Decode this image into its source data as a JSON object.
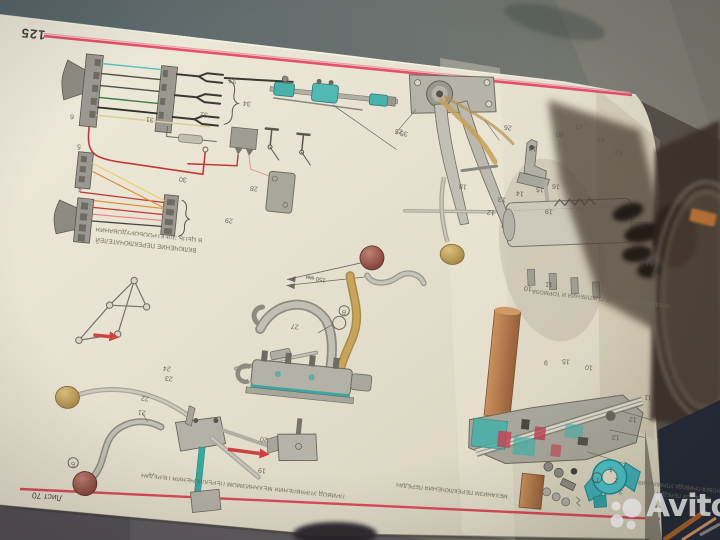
{
  "page": {
    "number": "125",
    "sheet": "Лист 70"
  },
  "watermark": {
    "text": "Avito"
  },
  "figures": {
    "wiring": {
      "caption_line1": "ВКЛЮЧЕНИЕ ПЕРЕКЛЮЧАТЕЛЕЙ",
      "caption_line2": "В ЦЕПЬ ЭЛЕКТРООБОРУДОВАНИЯ"
    },
    "pedals_cylinder": {
      "caption": "УСТАНОВКА ПЕДАЛЕЙ СЦЕПЛЕНИЯ И ТОРМОЗА"
    },
    "shift_linkage": {
      "caption": "ПРИВОД УПРАВЛЕНИЯ МЕХАНИЗМОМ ПЕРЕКЛЮЧЕНИЯ ПЕРЕДАЧ"
    },
    "shift_tower": {
      "caption": "МЕХАНИЗМ ПЕРЕКЛЮЧЕНИЯ ПЕРЕДАЧ"
    },
    "gearbox": {
      "caption_line1": "УСТАНОВКА ПРИВОДА УПРАВЛЕНИЯ",
      "caption_line2": "КОРОБКОЙ ПЕРЕДАЧ"
    },
    "dimension_label": "150 мм"
  },
  "part_labels": [
    {
      "t": "6",
      "x": 72,
      "y": 116
    },
    {
      "t": "31",
      "x": 150,
      "y": 119
    },
    {
      "t": "32",
      "x": 204,
      "y": 114
    },
    {
      "t": "33",
      "x": 233,
      "y": 80
    },
    {
      "t": "34",
      "x": 247,
      "y": 103
    },
    {
      "t": "28",
      "x": 254,
      "y": 188
    },
    {
      "t": "30",
      "x": 183,
      "y": 179
    },
    {
      "t": "29",
      "x": 229,
      "y": 220
    },
    {
      "t": "5",
      "x": 79,
      "y": 146
    },
    {
      "t": "4",
      "x": 80,
      "y": 189
    },
    {
      "t": "35",
      "x": 404,
      "y": 133
    },
    {
      "t": "25",
      "x": 399,
      "y": 131
    },
    {
      "t": "26",
      "x": 508,
      "y": 127
    },
    {
      "t": "18",
      "x": 463,
      "y": 186
    },
    {
      "t": "17",
      "x": 533,
      "y": 148
    },
    {
      "t": "16",
      "x": 556,
      "y": 186
    },
    {
      "t": "40",
      "x": 560,
      "y": 134
    },
    {
      "t": "41",
      "x": 579,
      "y": 126
    },
    {
      "t": "42",
      "x": 601,
      "y": 139
    },
    {
      "t": "43",
      "x": 619,
      "y": 152
    },
    {
      "t": "19",
      "x": 549,
      "y": 211
    },
    {
      "t": "13",
      "x": 502,
      "y": 199
    },
    {
      "t": "12",
      "x": 491,
      "y": 212
    },
    {
      "t": "14",
      "x": 520,
      "y": 193
    },
    {
      "t": "15",
      "x": 540,
      "y": 189
    },
    {
      "t": "44",
      "x": 650,
      "y": 263
    },
    {
      "t": "45",
      "x": 655,
      "y": 275
    },
    {
      "t": "10",
      "x": 528,
      "y": 288
    },
    {
      "t": "11",
      "x": 549,
      "y": 284
    },
    {
      "t": "21",
      "x": 142,
      "y": 412
    },
    {
      "t": "22",
      "x": 145,
      "y": 398
    },
    {
      "t": "23",
      "x": 169,
      "y": 378
    },
    {
      "t": "24",
      "x": 167,
      "y": 368
    },
    {
      "t": "27",
      "x": 295,
      "y": 326
    },
    {
      "t": "Б",
      "x": 73,
      "y": 463,
      "c": true
    },
    {
      "t": "В",
      "x": 344,
      "y": 311,
      "c": true
    },
    {
      "t": "20",
      "x": 264,
      "y": 439
    },
    {
      "t": "19",
      "x": 262,
      "y": 470
    },
    {
      "t": "9",
      "x": 546,
      "y": 362
    },
    {
      "t": "15",
      "x": 566,
      "y": 361
    },
    {
      "t": "10",
      "x": 589,
      "y": 367
    },
    {
      "t": "11",
      "x": 648,
      "y": 397
    },
    {
      "t": "12",
      "x": 633,
      "y": 419
    },
    {
      "t": "13",
      "x": 616,
      "y": 437
    },
    {
      "t": "1",
      "x": 611,
      "y": 469
    },
    {
      "t": "2",
      "x": 616,
      "y": 480
    },
    {
      "t": "3",
      "x": 621,
      "y": 491
    },
    {
      "t": "Г",
      "x": 597,
      "y": 478,
      "c": true
    }
  ],
  "colors": {
    "page": "#e9e4d4",
    "red_line": "#dd4a60",
    "teal_part": "#49b4ae",
    "tan_part": "#c8a35e",
    "copper_part": "#b87f4e",
    "crimson_part": "#c04858",
    "background": "#6a7270",
    "watermark": "#ffffff"
  }
}
